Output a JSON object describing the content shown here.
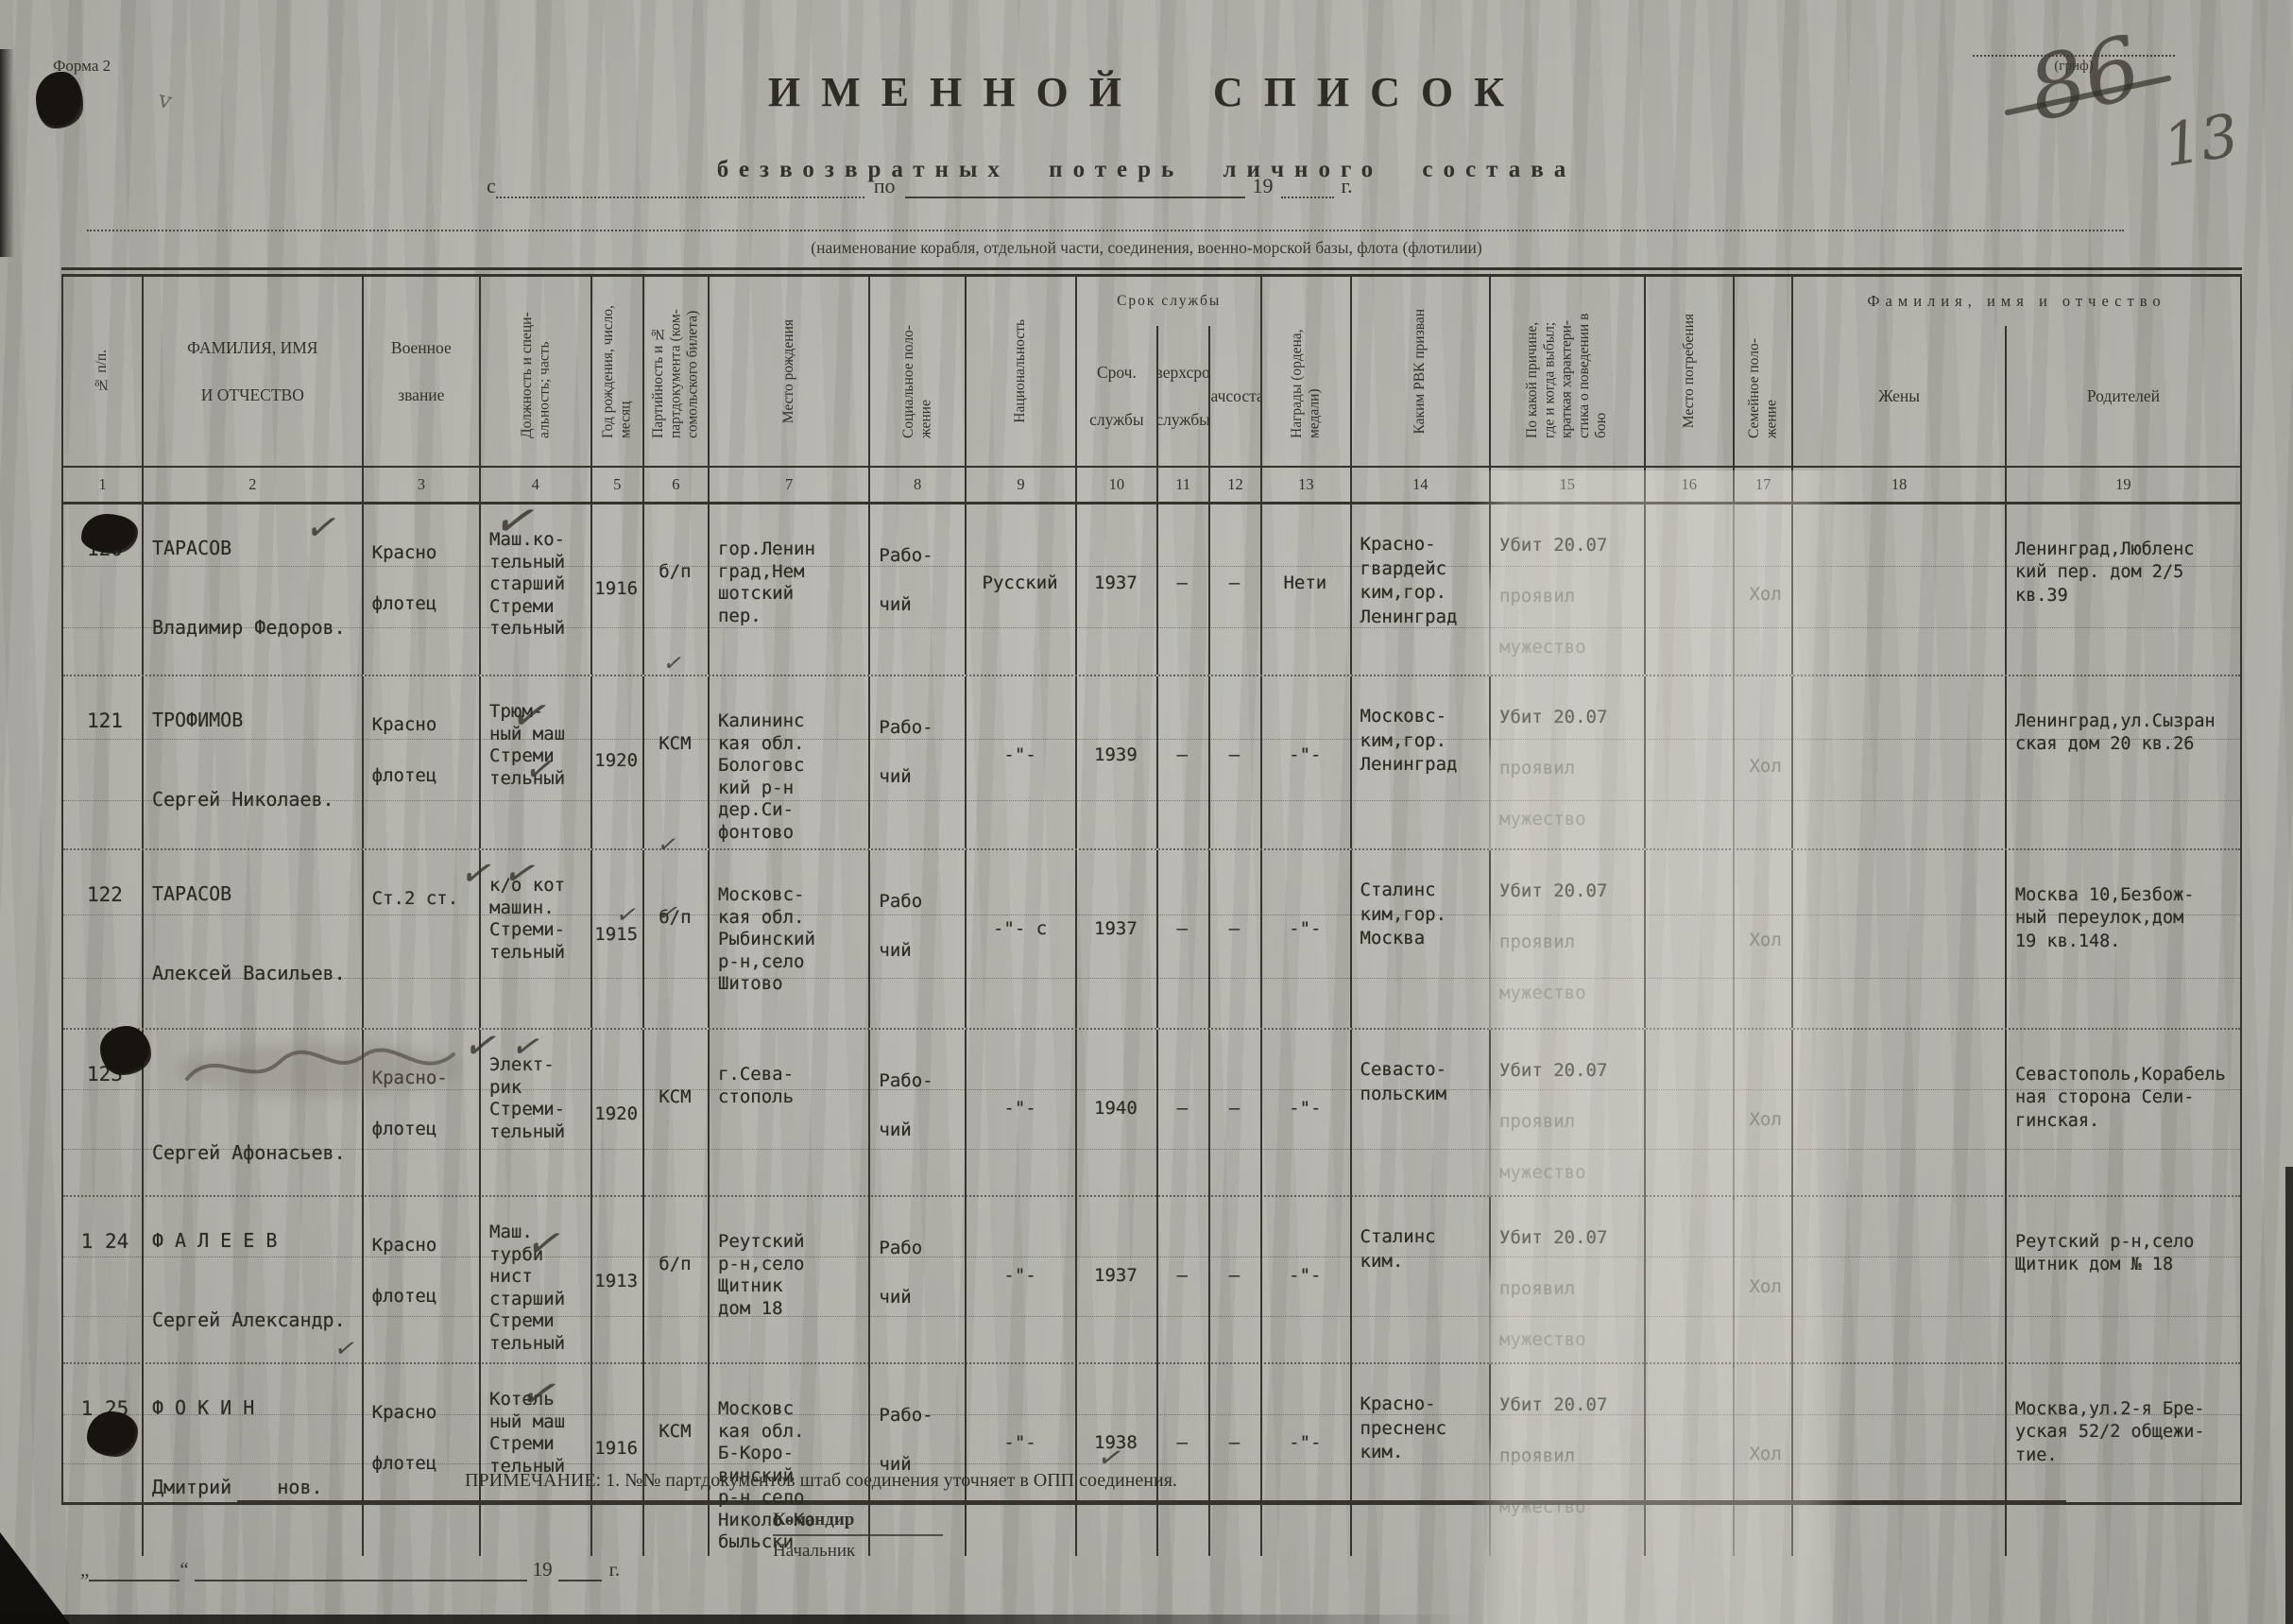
{
  "page": {
    "form_label": "Форма 2",
    "grif_label": "(гриф)",
    "handwritten_crossed_number": "86",
    "handwritten_page_number": "13",
    "title": "ИМЕННОЙ СПИСОК",
    "subtitle": "безвозвратных потерь личного состава",
    "date_from_label": "с",
    "date_to_label": "по",
    "year_prefix": "19",
    "year_suffix": "г.",
    "unit_caption": "(наименование корабля, отдельной части, соединения, военно-морской базы, флота (флотилии)"
  },
  "table": {
    "group_service": "Срок службы",
    "group_fio": "Фамилия, имя и отчество",
    "columns": [
      {
        "num": "1",
        "label": "№ п/п."
      },
      {
        "num": "2",
        "label": "ФАМИЛИЯ, ИМЯ\nИ ОТЧЕСТВО"
      },
      {
        "num": "3",
        "label": "Военное\nзвание"
      },
      {
        "num": "4",
        "label": "Должность и специ- альность; часть"
      },
      {
        "num": "5",
        "label": "Год рождения, число, месяц"
      },
      {
        "num": "6",
        "label": "Партийность и № партдокумента (ком- сомольского билета)"
      },
      {
        "num": "7",
        "label": "Место рождения"
      },
      {
        "num": "8",
        "label": "Социальное поло- жение"
      },
      {
        "num": "9",
        "label": "Национальность"
      },
      {
        "num": "10",
        "label": "Сроч. службы"
      },
      {
        "num": "11",
        "label": "Сверхсроч. службы"
      },
      {
        "num": "12",
        "label": "Начсостав"
      },
      {
        "num": "13",
        "label": "Награды (ордена, медали)"
      },
      {
        "num": "14",
        "label": "Каким РВК призван"
      },
      {
        "num": "15",
        "label": "По какой причине, где и когда выбыл; краткая характери- стика о поведении в бою"
      },
      {
        "num": "16",
        "label": "Место погребения"
      },
      {
        "num": "17",
        "label": "Семейное поло- жение"
      },
      {
        "num": "18",
        "label": "Жены"
      },
      {
        "num": "19",
        "label": "Родителей"
      }
    ]
  },
  "rows": [
    {
      "cells": [
        "120",
        "ТАРАСОВ\nВладимир Федоров.",
        "Красно\nфлотец",
        "Маш.ко-\nтельный\nстарший\nСтреми\nтельный",
        "1916",
        "б/п",
        "гор.Ленин\nград,Нем\nшотский\nпер.",
        "Рабо-\nчий",
        "Русский",
        "1937",
        "–",
        "–",
        "Нети",
        "Красно-\nгвардейс\nким,гор.\nЛенинград",
        "Убит 20.07\nпроявил\nмужество",
        "",
        "Хол",
        "",
        "Ленинград,Любленс\nкий пер. дом 2/5\nкв.39"
      ]
    },
    {
      "cells": [
        "121",
        "ТРОФИМОВ\nСергей Николаев.",
        "Красно\nфлотец",
        "Трюм-\nный маш\nСтреми\nтельный",
        "1920",
        "КСМ",
        "Калининс\nкая обл.\nБологовс\nкий р-н\nдер.Си-\nфонтово",
        "Рабо-\nчий",
        "-\"-",
        "1939",
        "–",
        "–",
        "-\"-",
        "Московс-\nким,гор.\nЛенинград",
        "Убит 20.07\nпроявил\nмужество",
        "",
        "Хол",
        "",
        "Ленинград,ул.Сызран\nская дом 20 кв.26"
      ]
    },
    {
      "cells": [
        "122",
        "ТАРАСОВ\nАлексей Васильев.",
        "Ст.2 ст.",
        "к/о кот\nмашин.\nСтреми-\nтельный",
        "1915",
        "б/п",
        "Московс-\nкая обл.\nРыбинский\nр-н,село\nШитово",
        "Рабо\nчий",
        "-\"- с",
        "1937",
        "–",
        "–",
        "-\"-",
        "Сталинс\nким,гор.\nМосква",
        "Убит 20.07\nпроявил\nмужество",
        "",
        "Хол",
        "",
        "Москва 10,Безбож-\nный переулок,дом\n19 кв.148."
      ]
    },
    {
      "cells": [
        "123",
        "\nСергей Афонасьев.",
        "Красно-\nфлотец",
        "Элект-\nрик\nСтреми-\nтельный",
        "1920",
        "КСМ",
        "г.Сева-\nстополь",
        "Рабо-\nчий",
        "-\"-",
        "1940",
        "–",
        "–",
        "-\"-",
        "Севасто-\nпольским",
        "Убит 20.07\nпроявил\nмужество",
        "",
        "Хол",
        "",
        "Севастополь,Корабель\nная сторона Сели-\nгинская."
      ]
    },
    {
      "cells": [
        "1 24",
        "Ф А Л Е Е В\nСергей Александр.",
        "Красно\nфлотец",
        "Маш.\nтурби\nнист\nстарший\nСтреми\nтельный",
        "1913",
        "б/п",
        "Реутский\nр-н,село\nЩитник\nдом 18",
        "Рабо\nчий",
        "-\"-",
        "1937",
        "–",
        "–",
        "-\"-",
        "Сталинс\nким.",
        "Убит 20.07\nпроявил\nмужество",
        "",
        "Хол",
        "",
        "Реутский р-н,село\nЩитник дом № 18"
      ]
    },
    {
      "cells": [
        "1 25",
        "Ф О К И Н\nДмитрий    нов.",
        "Красно\nфлотец",
        "Котель\nный маш\nСтреми\nтельный",
        "1916",
        "КСМ",
        "Московс\nкая обл.\nБ-Коро-\nвинский\nр-н село\nНиколо-Ко\nбыльски",
        "Рабо-\nчий",
        "-\"-",
        "1938",
        "–",
        "–",
        "-\"-",
        "Красно-\nпресненс\nким.",
        "Убит 20.07\nпроявил\nмужество",
        "",
        "Хол",
        "",
        "Москва,ул.2-я Бре-\nуская 52/2 общежи-\nтие."
      ]
    }
  ],
  "footer": {
    "note": "ПРИМЕЧАНИЕ: 1. №№ партдокументов штаб соединения уточняет в ОПП соединения.",
    "commander": "Командир",
    "chief": "Начальник",
    "quote_open": "„",
    "quote_close": "“",
    "year_prefix": "19",
    "year_suffix": "г."
  }
}
